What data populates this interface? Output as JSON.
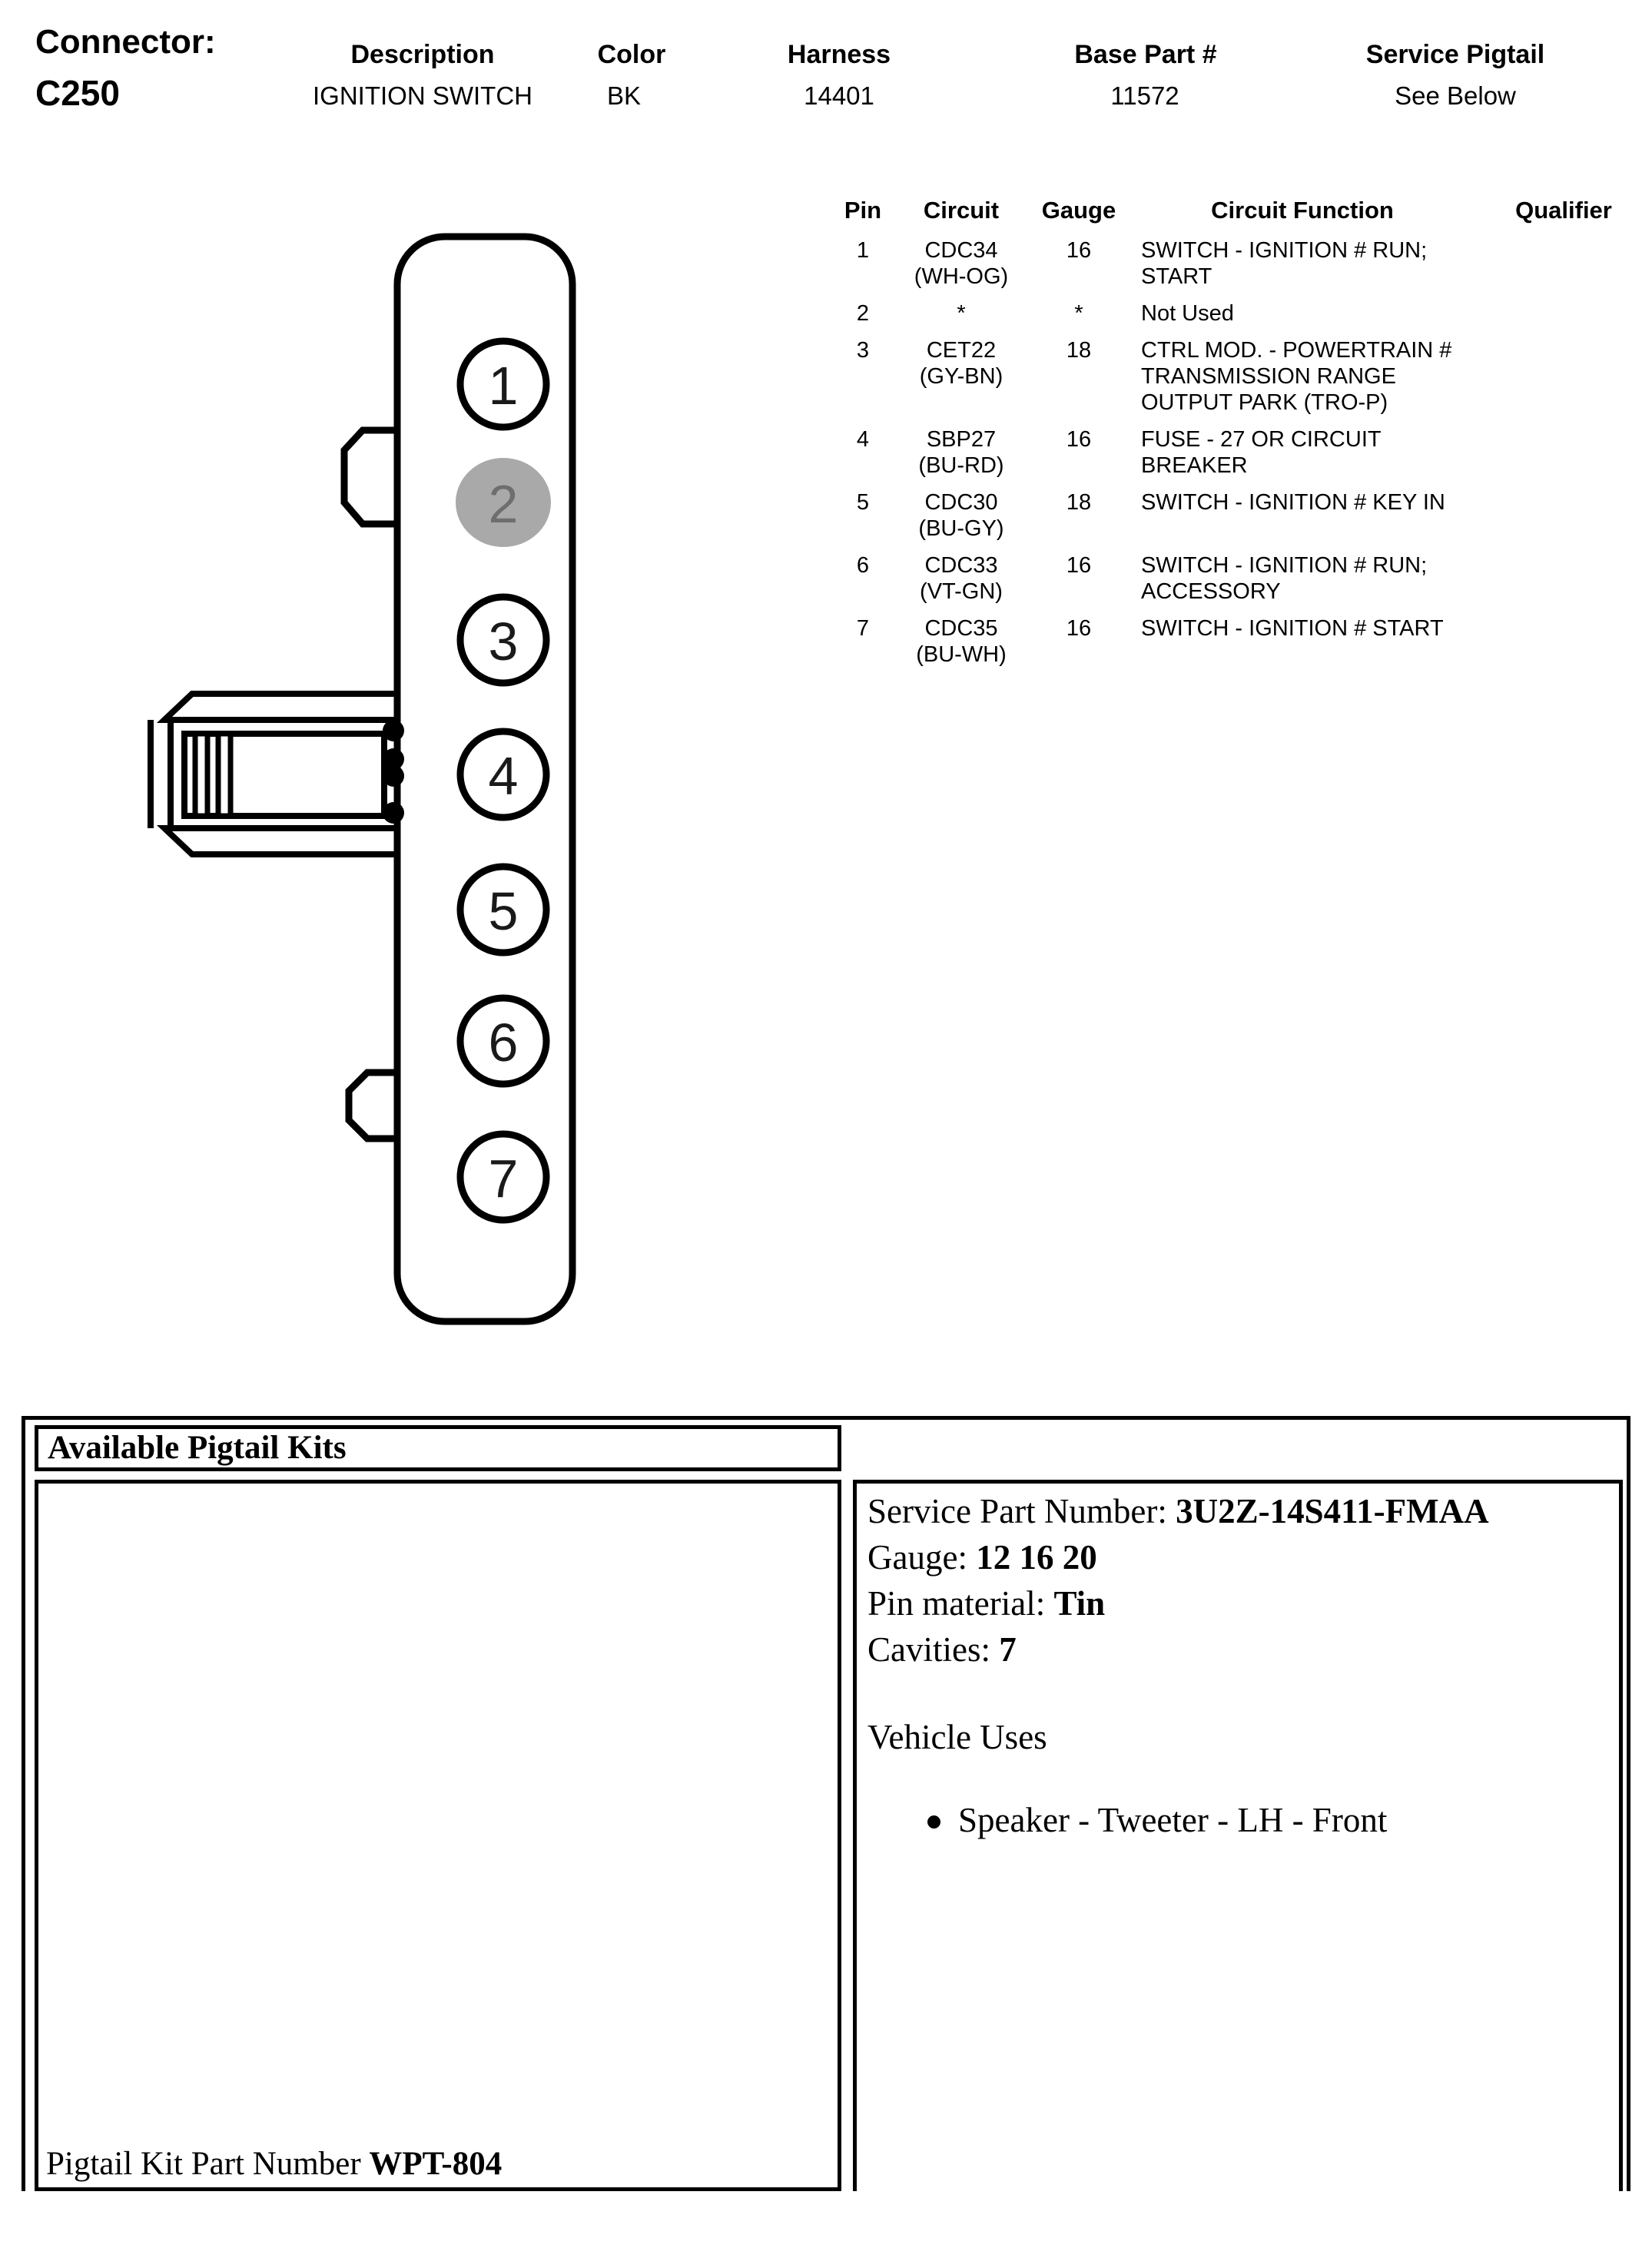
{
  "page": {
    "background": "#ffffff",
    "text_color": "#000000"
  },
  "header": {
    "connector_label": "Connector:",
    "connector_id": "C250",
    "fields": [
      {
        "label": "Description",
        "value": "IGNITION SWITCH"
      },
      {
        "label": "Color",
        "value": "BK"
      },
      {
        "label": "Harness",
        "value": "14401"
      },
      {
        "label": "Base Part #",
        "value": "11572"
      },
      {
        "label": "Service Pigtail",
        "value": "See Below"
      }
    ]
  },
  "pin_table": {
    "headers": [
      "Pin",
      "Circuit",
      "Gauge",
      "Circuit Function",
      "Qualifier"
    ],
    "rows": [
      {
        "pin": "1",
        "circuit": "CDC34\n(WH-OG)",
        "gauge": "16",
        "function": "SWITCH - IGNITION # RUN;\nSTART",
        "qualifier": ""
      },
      {
        "pin": "2",
        "circuit": "*",
        "gauge": "*",
        "function": "Not Used",
        "qualifier": ""
      },
      {
        "pin": "3",
        "circuit": "CET22\n(GY-BN)",
        "gauge": "18",
        "function": "CTRL MOD. - POWERTRAIN #\nTRANSMISSION RANGE\nOUTPUT PARK (TRO-P)",
        "qualifier": ""
      },
      {
        "pin": "4",
        "circuit": "SBP27\n(BU-RD)",
        "gauge": "16",
        "function": "FUSE - 27 OR CIRCUIT\nBREAKER",
        "qualifier": ""
      },
      {
        "pin": "5",
        "circuit": "CDC30\n(BU-GY)",
        "gauge": "18",
        "function": "SWITCH - IGNITION # KEY IN",
        "qualifier": ""
      },
      {
        "pin": "6",
        "circuit": "CDC33\n(VT-GN)",
        "gauge": "16",
        "function": "SWITCH - IGNITION # RUN;\nACCESSORY",
        "qualifier": ""
      },
      {
        "pin": "7",
        "circuit": "CDC35\n(BU-WH)",
        "gauge": "16",
        "function": "SWITCH - IGNITION # START",
        "qualifier": ""
      }
    ]
  },
  "diagram": {
    "pins": [
      "1",
      "2",
      "3",
      "4",
      "5",
      "6",
      "7"
    ],
    "highlighted_pin": "2",
    "pin_fill": "#ffffff",
    "highlight_fill": "#a9a9a9",
    "highlight_text_color": "#6e6e6e",
    "line_color": "#000000"
  },
  "pigtail_section": {
    "title": "Available Pigtail Kits",
    "details": [
      {
        "label": "Service Part Number: ",
        "value": "3U2Z-14S411-FMAA"
      },
      {
        "label": "Gauge: ",
        "value": "12 16 20"
      },
      {
        "label": "Pin material: ",
        "value": "Tin"
      },
      {
        "label": "Cavities: ",
        "value": "7"
      }
    ],
    "vehicle_uses_title": "Vehicle Uses",
    "vehicle_uses": [
      "Speaker - Tweeter - LH - Front"
    ],
    "kit_label": "Pigtail Kit Part Number ",
    "kit_value": "WPT-804"
  }
}
